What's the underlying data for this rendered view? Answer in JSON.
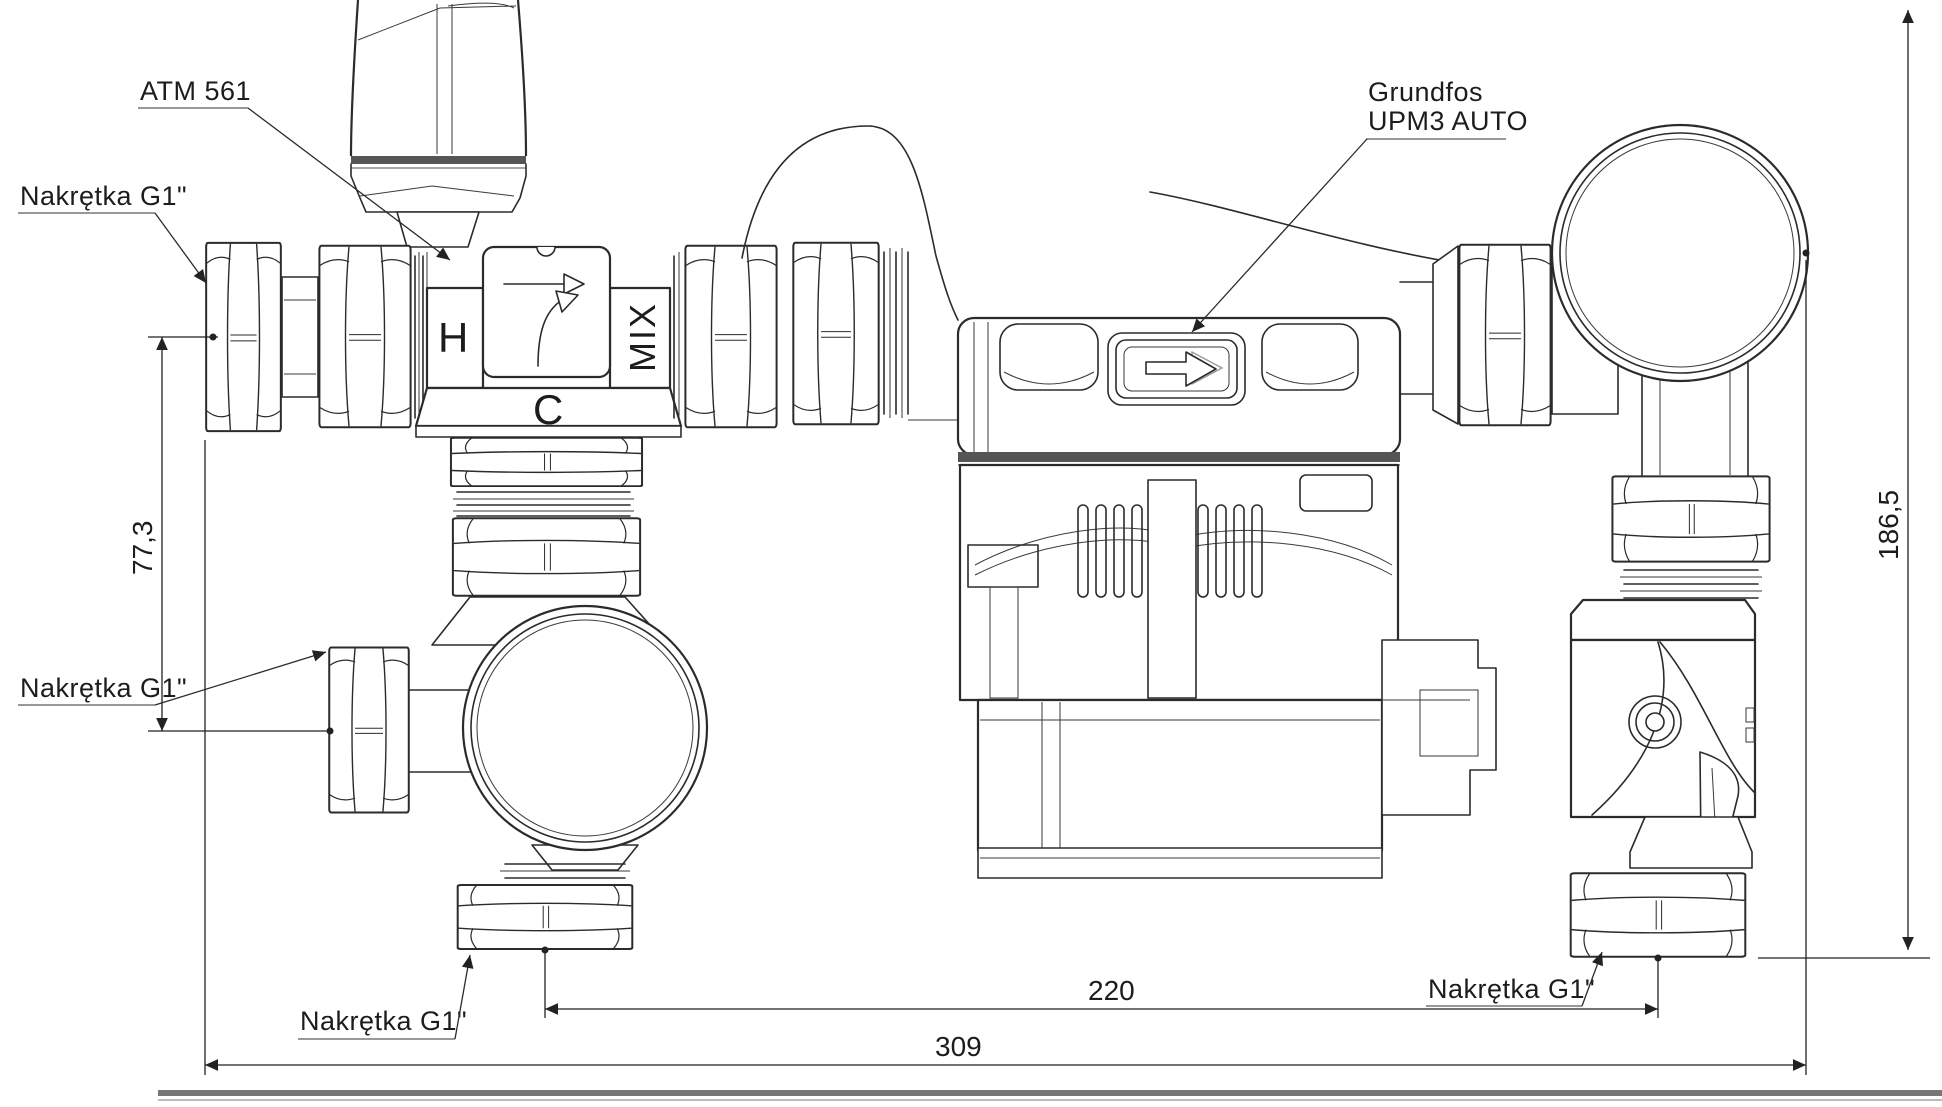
{
  "drawing": {
    "labels": {
      "valve_model": "ATM 561",
      "pump_brand": "Grundfos",
      "pump_model": "UPM3 AUTO",
      "nut_top_left": "Nakrętka G1\"",
      "nut_side_left": "Nakrętka G1\"",
      "nut_bottom_left": "Nakrętka G1\"",
      "nut_bottom_right": "Nakrętka G1\""
    },
    "port_marks": {
      "hot": "H",
      "mix": "MIX",
      "cold": "C"
    },
    "dimensions": {
      "axis_offset": "77,3",
      "overall_height": "186,5",
      "pump_group_width": "220",
      "overall_width": "309"
    },
    "colors": {
      "line": "#2b2b2b",
      "dim_text": "#1c1c1c",
      "underline_gray": "#8a8a8a",
      "band_gray": "#555555"
    }
  }
}
